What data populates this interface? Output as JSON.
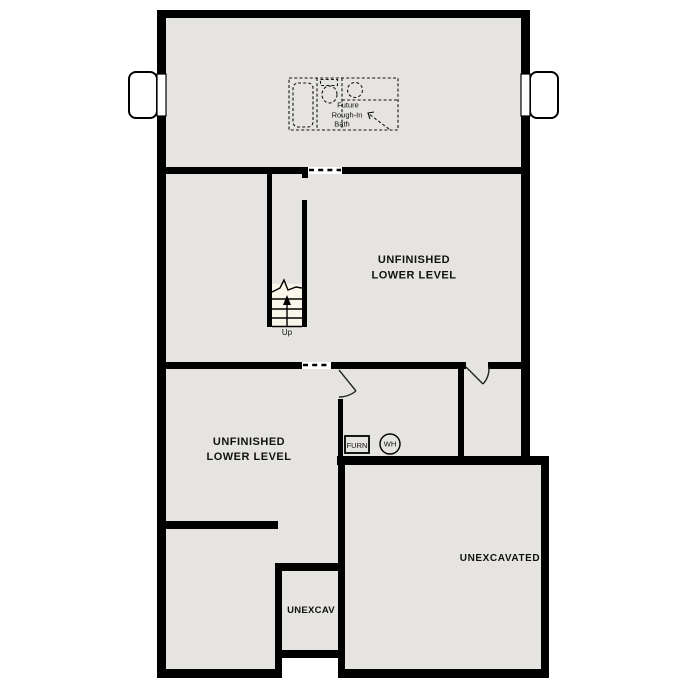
{
  "title": "Lower Level Floor Plan",
  "colors": {
    "wall": "#000000",
    "floor": "#e5e4e0",
    "stair_tread": "#faf6ea",
    "background": "#ffffff",
    "text": "#111111"
  },
  "rooms": {
    "middle": {
      "line1": "UNFINISHED",
      "line2": "LOWER LEVEL"
    },
    "lower_left": {
      "line1": "UNFINISHED",
      "line2": "LOWER LEVEL"
    },
    "unexcavated_large": {
      "label": "UNEXCAVATED"
    },
    "unexcavated_small": {
      "label": "UNEXCAV"
    }
  },
  "future_bath": {
    "line1": "Future",
    "line2": "Rough-In",
    "line3": "Bath"
  },
  "equipment": {
    "furnace": "FURN",
    "water_heater": "WH"
  },
  "stairs": {
    "direction": "Up"
  }
}
